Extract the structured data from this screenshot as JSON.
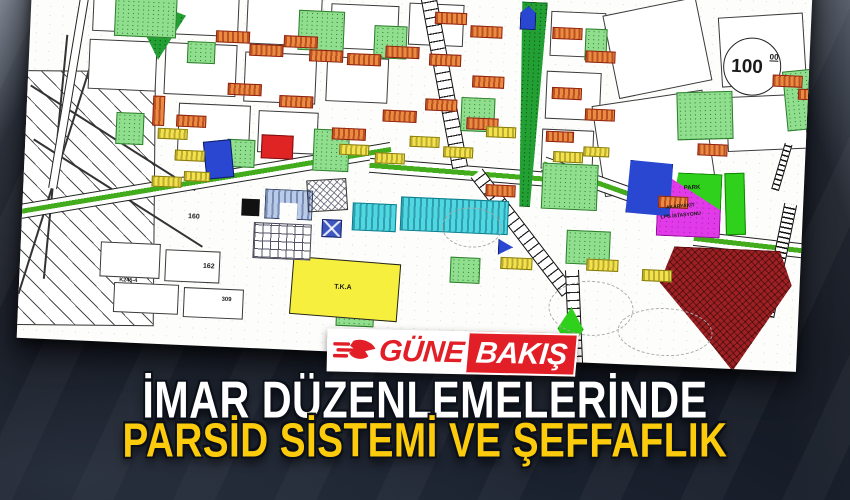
{
  "logo": {
    "prefix": "GÜNE",
    "suffix": "BAKIŞ",
    "red": "#e21f26"
  },
  "headline": {
    "line1": "İMAR DÜZENLEMELERİNDE",
    "line2": "PARSİD SİSTEMİ VE ŞEFFAFLIK",
    "line1_color": "#ffffff",
    "line2_color": "#fbcb0c"
  },
  "map": {
    "elevation_circle": {
      "value": "100",
      "sup": "00"
    },
    "labels": [
      {
        "t": "100",
        "x": 702,
        "y": 88,
        "fs": 19
      },
      {
        "t": "00",
        "x": 740,
        "y": 83,
        "fs": 8,
        "u": 1
      },
      {
        "t": "PARK",
        "x": 660,
        "y": 218,
        "fs": 6,
        "rot": -5
      },
      {
        "t": "AKARYAKIT",
        "x": 643,
        "y": 238,
        "fs": 5,
        "rot": -8
      },
      {
        "t": "LPG İSTASYONU",
        "x": 638,
        "y": 247,
        "fs": 5,
        "rot": -8
      },
      {
        "t": "T.K.A",
        "x": 315,
        "y": 332,
        "fs": 7
      },
      {
        "t": "160",
        "x": 166,
        "y": 268,
        "fs": 7
      },
      {
        "t": "162",
        "x": 183,
        "y": 317,
        "fs": 7
      },
      {
        "t": "309",
        "x": 203,
        "y": 350,
        "fs": 6
      },
      {
        "t": "K245-4",
        "x": 100,
        "y": 336,
        "fs": 5.5
      }
    ],
    "shapes": [
      {
        "n": "field-area",
        "cls": "z-fld",
        "x": -8,
        "y": 130,
        "w": 140,
        "h": 255,
        "rot": -2
      },
      {
        "n": "field-line",
        "cls": "z-line",
        "x": -10,
        "y": 195,
        "w": 195,
        "h": 2,
        "rot": 30
      },
      {
        "n": "field-line",
        "cls": "z-line",
        "x": -5,
        "y": 250,
        "w": 200,
        "h": 2,
        "rot": 30
      },
      {
        "n": "field-line",
        "cls": "z-line",
        "x": 30,
        "y": 120,
        "w": 2,
        "h": 240,
        "rot": 15
      },
      {
        "n": "frame-line",
        "cls": "z-line",
        "x": 30,
        "y": 95,
        "w": 2,
        "h": 245,
        "rot": 3
      },
      {
        "n": "parcel",
        "cls": "z-pc",
        "x": 62,
        "y": 42,
        "w": 70,
        "h": 48
      },
      {
        "n": "parcel",
        "cls": "z-pc",
        "x": 140,
        "y": 45,
        "w": 68,
        "h": 45
      },
      {
        "n": "parcel",
        "cls": "z-pc",
        "x": 216,
        "y": 48,
        "w": 75,
        "h": 48
      },
      {
        "n": "parcel",
        "cls": "z-pc",
        "x": 300,
        "y": 52,
        "w": 68,
        "h": 45
      },
      {
        "n": "parcel",
        "cls": "z-pc",
        "x": 378,
        "y": 48,
        "w": 55,
        "h": 42
      },
      {
        "n": "parcel",
        "cls": "z-pc",
        "x": 60,
        "y": 98,
        "w": 68,
        "h": 50
      },
      {
        "n": "parcel",
        "cls": "z-pc",
        "x": 136,
        "y": 98,
        "w": 72,
        "h": 52
      },
      {
        "n": "parcel",
        "cls": "z-pc",
        "x": 216,
        "y": 104,
        "w": 72,
        "h": 50
      },
      {
        "n": "parcel",
        "cls": "z-pc",
        "x": 298,
        "y": 105,
        "w": 62,
        "h": 45
      },
      {
        "n": "parcel",
        "cls": "z-pc",
        "x": 152,
        "y": 158,
        "w": 72,
        "h": 50
      },
      {
        "n": "parcel",
        "cls": "z-pc",
        "x": 232,
        "y": 162,
        "w": 60,
        "h": 42
      },
      {
        "n": "parcel",
        "cls": "z-pc",
        "x": 520,
        "y": 50,
        "w": 55,
        "h": 45
      },
      {
        "n": "parcel",
        "cls": "z-pc",
        "x": 518,
        "y": 110,
        "w": 55,
        "h": 48
      },
      {
        "n": "parcel",
        "cls": "z-pc",
        "x": 516,
        "y": 168,
        "w": 52,
        "h": 40
      },
      {
        "n": "empty-parcel",
        "cls": "z-pc",
        "x": 580,
        "y": 40,
        "w": 95,
        "h": 85,
        "rot": -14
      },
      {
        "n": "empty-parcel",
        "cls": "z-pc",
        "x": 572,
        "y": 132,
        "w": 112,
        "h": 92,
        "rot": -11
      },
      {
        "n": "parcel",
        "cls": "z-pc",
        "x": 690,
        "y": 45,
        "w": 85,
        "h": 70,
        "rot": -6
      },
      {
        "n": "parcel",
        "cls": "z-pc",
        "x": 700,
        "y": 125,
        "w": 80,
        "h": 55,
        "rot": -5
      },
      {
        "n": "parcel",
        "cls": "z-pc",
        "x": 80,
        "y": 300,
        "w": 60,
        "h": 35
      },
      {
        "n": "parcel",
        "cls": "z-pc",
        "x": 145,
        "y": 305,
        "w": 55,
        "h": 32
      },
      {
        "n": "parcel",
        "cls": "z-pc",
        "x": 95,
        "y": 340,
        "w": 65,
        "h": 30
      },
      {
        "n": "parcel",
        "cls": "z-pc",
        "x": 165,
        "y": 342,
        "w": 60,
        "h": 30
      },
      {
        "n": "road",
        "cls": "z-road",
        "x": 38,
        "y": 35,
        "w": 9,
        "h": 215,
        "rot": 7
      },
      {
        "n": "avenue",
        "cls": "z-ave",
        "x": -15,
        "y": 228,
        "w": 385,
        "h": 15,
        "rot": -12
      },
      {
        "n": "avenue",
        "cls": "z-ave",
        "x": 345,
        "y": 208,
        "w": 185,
        "h": 15,
        "rot": 2
      },
      {
        "n": "avenue",
        "cls": "z-ave",
        "x": 515,
        "y": 222,
        "w": 180,
        "h": 15,
        "rot": 17
      },
      {
        "n": "avenue",
        "cls": "z-ave",
        "x": 672,
        "y": 268,
        "w": 125,
        "h": 15,
        "rot": 4
      },
      {
        "n": "boulevard",
        "cls": "z-blvd",
        "x": 408,
        "y": 38,
        "w": 16,
        "h": 175,
        "rot": -13
      },
      {
        "n": "boulevard",
        "cls": "z-blvd",
        "x": 493,
        "y": 198,
        "w": 15,
        "h": 150,
        "rot": -40
      },
      {
        "n": "boulevard",
        "cls": "z-blvd",
        "x": 549,
        "y": 308,
        "w": 14,
        "h": 95,
        "rot": -5
      },
      {
        "n": "railway",
        "cls": "z-rail",
        "x": 752,
        "y": 232,
        "w": 13,
        "h": 115,
        "rot": 9
      },
      {
        "n": "railway",
        "cls": "z-rail",
        "x": 753,
        "y": 172,
        "w": 8,
        "h": 48,
        "rot": 14
      },
      {
        "n": "park-band",
        "cls": "z-dg",
        "x": 486,
        "y": 42,
        "w": 30,
        "h": 205,
        "clip": "polygon(15% 0,100% 0,70% 100%,35% 100%)"
      },
      {
        "n": "park-triangle",
        "cls": "z-dg",
        "x": 117,
        "y": 58,
        "w": 38,
        "h": 58,
        "clip": "polygon(0 0,100% 22%,32% 100%,0 62%)"
      },
      {
        "n": "green-area",
        "cls": "z-gr",
        "x": 84,
        "y": 52,
        "w": 62,
        "h": 42
      },
      {
        "n": "green-area",
        "cls": "z-gr",
        "x": 268,
        "y": 60,
        "w": 46,
        "h": 40
      },
      {
        "n": "green-area",
        "cls": "z-gr",
        "x": 344,
        "y": 72,
        "w": 33,
        "h": 33
      },
      {
        "n": "green-area",
        "cls": "z-gr",
        "x": 158,
        "y": 96,
        "w": 28,
        "h": 22
      },
      {
        "n": "green-area",
        "cls": "z-gr",
        "x": 202,
        "y": 192,
        "w": 28,
        "h": 28
      },
      {
        "n": "green-area",
        "cls": "z-gr",
        "x": 288,
        "y": 178,
        "w": 36,
        "h": 42
      },
      {
        "n": "green-area",
        "cls": "z-gr",
        "x": 90,
        "y": 170,
        "w": 28,
        "h": 32
      },
      {
        "n": "green-area",
        "cls": "z-gr",
        "x": 434,
        "y": 140,
        "w": 34,
        "h": 34
      },
      {
        "n": "green-area",
        "cls": "z-gr",
        "x": 555,
        "y": 66,
        "w": 22,
        "h": 32
      },
      {
        "n": "green-area",
        "cls": "z-gr",
        "x": 650,
        "y": 124,
        "w": 56,
        "h": 48,
        "rot": -4
      },
      {
        "n": "green-area",
        "cls": "z-gr",
        "x": 757,
        "y": 98,
        "w": 36,
        "h": 60,
        "rot": -8
      },
      {
        "n": "green-area",
        "cls": "z-gr",
        "x": 518,
        "y": 202,
        "w": 56,
        "h": 46
      },
      {
        "n": "green-area",
        "cls": "z-gr",
        "x": 545,
        "y": 268,
        "w": 44,
        "h": 34
      },
      {
        "n": "green-area",
        "cls": "z-gr",
        "x": 318,
        "y": 348,
        "w": 38,
        "h": 26
      },
      {
        "n": "green-area",
        "cls": "z-gr",
        "x": 430,
        "y": 300,
        "w": 30,
        "h": 26
      },
      {
        "n": "park-parcel",
        "cls": "z-gr2",
        "x": 648,
        "y": 206,
        "w": 50,
        "h": 38,
        "clip": "polygon(12% 0,100% 0,100% 100%,0 100%)"
      },
      {
        "n": "park-parcel",
        "cls": "z-gr2",
        "x": 702,
        "y": 204,
        "w": 20,
        "h": 62,
        "rot": -4
      },
      {
        "n": "green-diamond",
        "cls": "z-gr2",
        "x": 540,
        "y": 345,
        "w": 26,
        "h": 44,
        "clip": "polygon(50% 0,100% 50%,50% 100%,0 50%)"
      },
      {
        "n": "fuel-station-zone",
        "cls": "z-mg",
        "x": 634,
        "y": 212,
        "w": 64,
        "h": 58,
        "clip": "polygon(20% 0,100% 52%,100% 100%,0 100%,0 30%)"
      },
      {
        "n": "dark-red-zone",
        "cls": "z-dr",
        "x": 640,
        "y": 280,
        "w": 132,
        "h": 122,
        "clip": "polygon(10% 0,90% 0,100% 28%,58% 100%,42% 80%,0 30%)"
      },
      {
        "n": "school-zone-yellow",
        "cls": "z-yl",
        "x": 272,
        "y": 308,
        "w": 108,
        "h": 58,
        "rot": 2
      },
      {
        "n": "cyan-building",
        "cls": "z-cy",
        "x": 330,
        "y": 250,
        "w": 44,
        "h": 28
      },
      {
        "n": "cyan-building",
        "cls": "z-cy",
        "x": 378,
        "y": 242,
        "w": 108,
        "h": 34
      },
      {
        "n": "public-building",
        "cls": "z-lb",
        "x": 242,
        "y": 240,
        "w": 48,
        "h": 30,
        "clip": "polygon(0 0,100% 0,100% 100%,68% 100%,68% 45%,32% 45%,32% 100%,0 100%)"
      },
      {
        "n": "cells-grid",
        "cls": "z-grid",
        "x": 232,
        "y": 274,
        "w": 58,
        "h": 36
      },
      {
        "n": "blue-zone",
        "cls": "z-bl",
        "x": 180,
        "y": 194,
        "w": 28,
        "h": 38,
        "rot": -8
      },
      {
        "n": "blue-zone",
        "cls": "z-bl",
        "x": 598,
        "y": 192,
        "w": 55,
        "h": 62,
        "rot": -12,
        "clip": "polygon(25% 0,100% 18%,78% 100%,0 82%)"
      },
      {
        "n": "blue-x-square",
        "cls": "z-blx",
        "x": 300,
        "y": 268,
        "w": 20,
        "h": 18
      },
      {
        "n": "blue-triangle",
        "cls": "z-bl",
        "x": 477,
        "y": 280,
        "w": 15,
        "h": 16,
        "clip": "polygon(0 0,100% 50%,0 100%)"
      },
      {
        "n": "blue-pentagon",
        "cls": "z-bl",
        "x": 489,
        "y": 46,
        "w": 16,
        "h": 24,
        "clip": "polygon(50% 0,100% 30%,100% 100%,0 100%,0 30%)"
      },
      {
        "n": "red-zone",
        "cls": "z-rd2",
        "x": 236,
        "y": 186,
        "w": 32,
        "h": 24
      },
      {
        "n": "black-square",
        "cls": "z-bk",
        "x": 219,
        "y": 251,
        "w": 18,
        "h": 17
      },
      {
        "n": "crosshatch-zone",
        "cls": "z-xh",
        "x": 284,
        "y": 228,
        "w": 40,
        "h": 32,
        "rot": -6
      },
      {
        "n": "contour",
        "cls": "z-ct",
        "x": 530,
        "y": 318,
        "w": 85,
        "h": 55
      },
      {
        "n": "contour",
        "cls": "z-ct",
        "x": 600,
        "y": 342,
        "w": 95,
        "h": 48
      },
      {
        "n": "contour",
        "cls": "z-ct",
        "x": 420,
        "y": 250,
        "w": 60,
        "h": 40
      },
      {
        "n": "elevation-circle",
        "cls": "z-circle",
        "x": 694,
        "y": 68,
        "w": 58,
        "h": 58
      },
      {
        "n": "building",
        "cls": "b-or",
        "x": 186,
        "y": 84,
        "w": 34,
        "h": 12
      },
      {
        "n": "building",
        "cls": "b-or",
        "x": 220,
        "y": 96,
        "w": 34,
        "h": 12
      },
      {
        "n": "building",
        "cls": "b-or",
        "x": 254,
        "y": 86,
        "w": 34,
        "h": 12
      },
      {
        "n": "building",
        "cls": "b-or",
        "x": 280,
        "y": 99,
        "w": 34,
        "h": 12
      },
      {
        "n": "building",
        "cls": "b-or",
        "x": 318,
        "y": 101,
        "w": 34,
        "h": 12
      },
      {
        "n": "building",
        "cls": "b-or",
        "x": 356,
        "y": 92,
        "w": 34,
        "h": 12
      },
      {
        "n": "building",
        "cls": "b-or",
        "x": 200,
        "y": 136,
        "w": 34,
        "h": 12
      },
      {
        "n": "building",
        "cls": "b-or",
        "x": 252,
        "y": 146,
        "w": 34,
        "h": 12
      },
      {
        "n": "building",
        "cls": "b-or",
        "x": 306,
        "y": 176,
        "w": 34,
        "h": 12
      },
      {
        "n": "building",
        "cls": "b-or",
        "x": 356,
        "y": 156,
        "w": 34,
        "h": 12
      },
      {
        "n": "building",
        "cls": "b-or",
        "x": 126,
        "y": 152,
        "w": 12,
        "h": 30
      },
      {
        "n": "building",
        "cls": "b-or",
        "x": 150,
        "y": 170,
        "w": 30,
        "h": 12
      },
      {
        "n": "building",
        "cls": "b-or",
        "x": 404,
        "y": 56,
        "w": 32,
        "h": 12
      },
      {
        "n": "building",
        "cls": "b-or",
        "x": 440,
        "y": 68,
        "w": 32,
        "h": 12
      },
      {
        "n": "building",
        "cls": "b-or",
        "x": 400,
        "y": 98,
        "w": 32,
        "h": 12
      },
      {
        "n": "building",
        "cls": "b-or",
        "x": 444,
        "y": 118,
        "w": 32,
        "h": 12
      },
      {
        "n": "building",
        "cls": "b-or",
        "x": 398,
        "y": 143,
        "w": 32,
        "h": 12
      },
      {
        "n": "building",
        "cls": "b-or",
        "x": 440,
        "y": 160,
        "w": 32,
        "h": 12
      },
      {
        "n": "building",
        "cls": "b-or",
        "x": 522,
        "y": 66,
        "w": 30,
        "h": 12
      },
      {
        "n": "building",
        "cls": "b-or",
        "x": 556,
        "y": 88,
        "w": 30,
        "h": 12
      },
      {
        "n": "building",
        "cls": "b-or",
        "x": 524,
        "y": 126,
        "w": 30,
        "h": 12
      },
      {
        "n": "building",
        "cls": "b-or",
        "x": 558,
        "y": 146,
        "w": 30,
        "h": 12
      },
      {
        "n": "building",
        "cls": "b-or",
        "x": 520,
        "y": 170,
        "w": 28,
        "h": 11
      },
      {
        "n": "building",
        "cls": "b-or",
        "x": 744,
        "y": 104,
        "w": 30,
        "h": 12
      },
      {
        "n": "building",
        "cls": "b-or",
        "x": 770,
        "y": 117,
        "w": 28,
        "h": 11
      },
      {
        "n": "building",
        "cls": "b-or",
        "x": 635,
        "y": 230,
        "w": 30,
        "h": 12
      },
      {
        "n": "building",
        "cls": "b-or",
        "x": 672,
        "y": 176,
        "w": 30,
        "h": 12
      },
      {
        "n": "building",
        "cls": "b-or",
        "x": 462,
        "y": 226,
        "w": 30,
        "h": 12
      },
      {
        "n": "building-yellow",
        "cls": "b-ye",
        "x": 132,
        "y": 184,
        "w": 30,
        "h": 11
      },
      {
        "n": "building-yellow",
        "cls": "b-ye",
        "x": 150,
        "y": 205,
        "w": 30,
        "h": 11
      },
      {
        "n": "building-yellow",
        "cls": "b-ye",
        "x": 128,
        "y": 232,
        "w": 30,
        "h": 11
      },
      {
        "n": "building-yellow",
        "cls": "b-ye",
        "x": 160,
        "y": 226,
        "w": 26,
        "h": 10
      },
      {
        "n": "building-yellow",
        "cls": "b-ye",
        "x": 314,
        "y": 192,
        "w": 30,
        "h": 11
      },
      {
        "n": "building-yellow",
        "cls": "b-ye",
        "x": 350,
        "y": 199,
        "w": 30,
        "h": 11
      },
      {
        "n": "building-yellow",
        "cls": "b-ye",
        "x": 384,
        "y": 181,
        "w": 30,
        "h": 11
      },
      {
        "n": "building-yellow",
        "cls": "b-ye",
        "x": 418,
        "y": 190,
        "w": 30,
        "h": 11
      },
      {
        "n": "building-yellow",
        "cls": "b-ye",
        "x": 460,
        "y": 168,
        "w": 30,
        "h": 11
      },
      {
        "n": "building-yellow",
        "cls": "b-ye",
        "x": 528,
        "y": 190,
        "w": 30,
        "h": 11
      },
      {
        "n": "building-yellow",
        "cls": "b-ye",
        "x": 558,
        "y": 184,
        "w": 26,
        "h": 10
      },
      {
        "n": "building-yellow",
        "cls": "b-ye",
        "x": 480,
        "y": 298,
        "w": 32,
        "h": 12
      },
      {
        "n": "building-yellow",
        "cls": "b-ye",
        "x": 566,
        "y": 296,
        "w": 32,
        "h": 12
      },
      {
        "n": "building-yellow",
        "cls": "b-ye",
        "x": 622,
        "y": 304,
        "w": 30,
        "h": 12
      }
    ]
  }
}
